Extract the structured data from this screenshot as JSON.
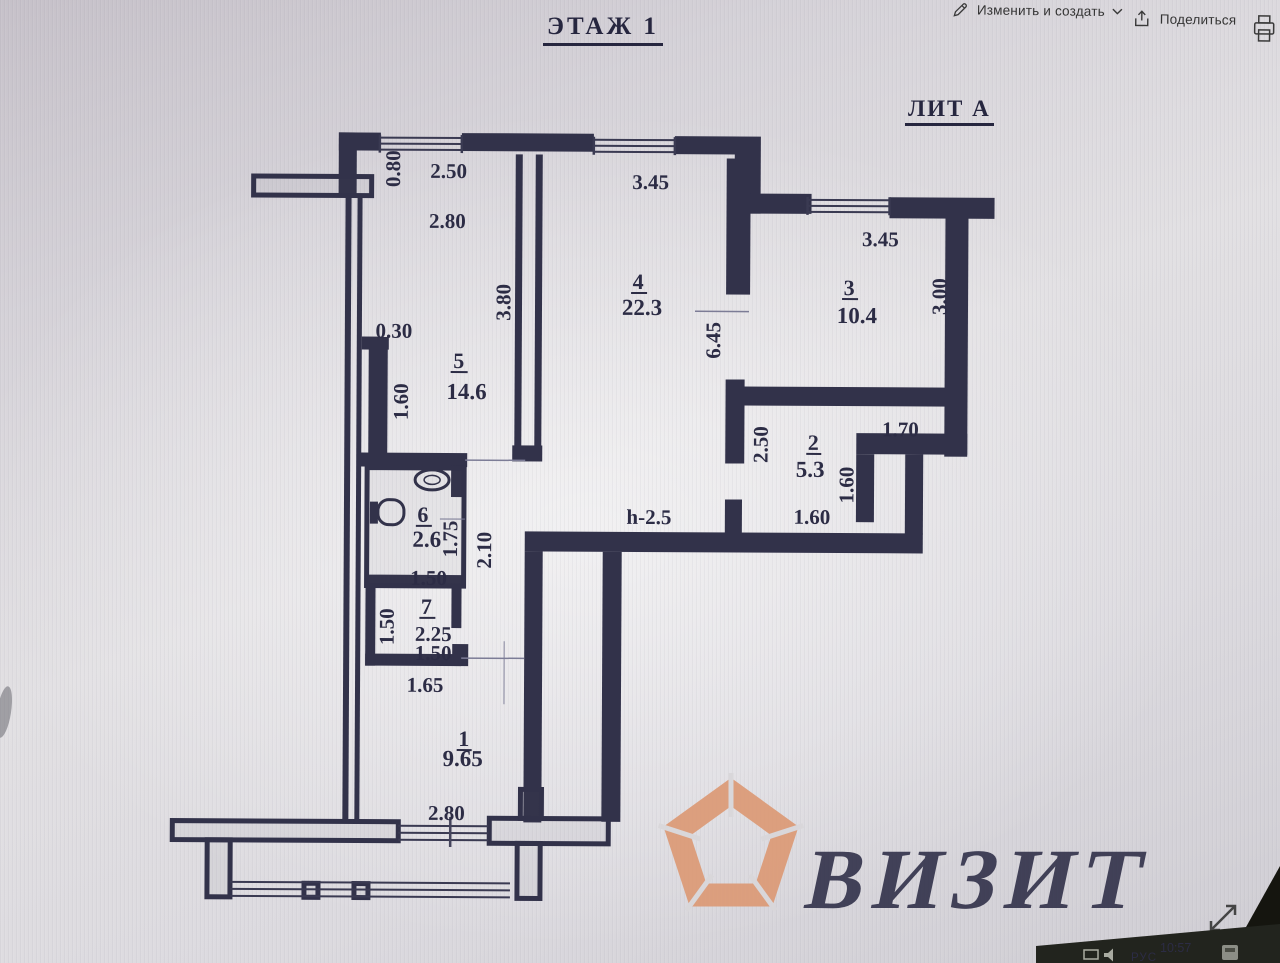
{
  "window": {
    "toolbar": {
      "edit_create_label": "Изменить и создать",
      "share_label": "Поделиться"
    }
  },
  "plan": {
    "title": "ЭТАЖ 1",
    "lit_label": "ЛИТ А",
    "height_note": "h-2.5",
    "rooms": {
      "r1": {
        "num": "1",
        "area": "9.65"
      },
      "r2": {
        "num": "2",
        "area": "5.3"
      },
      "r3": {
        "num": "3",
        "area": "10.4"
      },
      "r4": {
        "num": "4",
        "area": "22.3"
      },
      "r5": {
        "num": "5",
        "area": "14.6"
      },
      "r6": {
        "num": "6",
        "area": "2.6"
      },
      "r7": {
        "num": "7",
        "area": "2.25"
      }
    },
    "dims": {
      "d080": "0.80",
      "d250_top": "2.50",
      "d280_top": "2.80",
      "d345_mid": "3.45",
      "d345_right": "3.45",
      "d300": "3.00",
      "d030": "0.30",
      "d380": "3.80",
      "d160_left": "1.60",
      "d645": "6.45",
      "d250_vert": "2.50",
      "d170": "1.70",
      "d160_vert": "1.60",
      "d160_horiz": "1.60",
      "d175": "1.75",
      "d210": "2.10",
      "d150_bath": "1.50",
      "d150_vert": "1.50",
      "d225": "2.25",
      "d150_r7": "1.50",
      "d165": "1.65",
      "d280_bot": "2.80"
    }
  },
  "watermark": {
    "text": "ВИЗИТ",
    "logo_color": "#dc9a76",
    "text_color": "#edebe9"
  },
  "taskbar": {
    "time": "10:57",
    "lang": "РУС"
  },
  "icons": {
    "resize_arrow": "⤢"
  },
  "colors": {
    "ink": "#2c2c45",
    "wall": "#32324a",
    "logo_orange": "#dc9a76",
    "taskbar_bg": "#22241e"
  }
}
